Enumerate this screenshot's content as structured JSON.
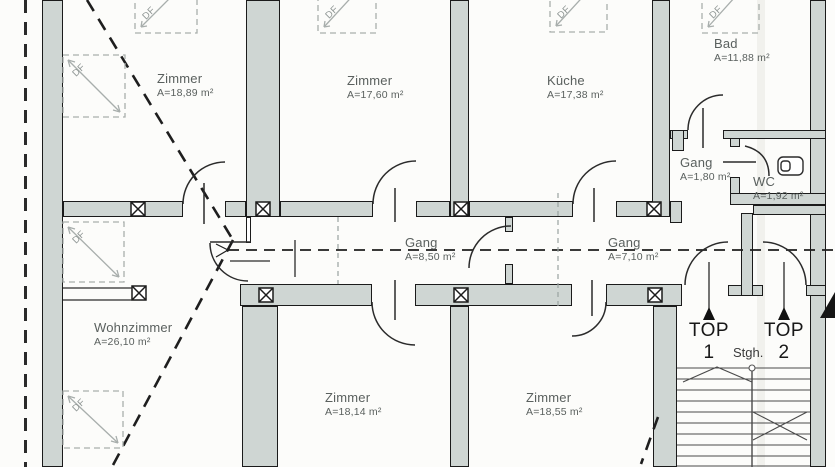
{
  "plan": {
    "rooms": [
      {
        "name": "Zimmer",
        "area": "A=18,89 m²"
      },
      {
        "name": "Zimmer",
        "area": "A=17,60 m²"
      },
      {
        "name": "Küche",
        "area": "A=17,38 m²"
      },
      {
        "name": "Bad",
        "area": "A=11,88 m²"
      },
      {
        "name": "Gang",
        "area": "A=1,80 m²"
      },
      {
        "name": "WC",
        "area": "A=1,92 m²"
      },
      {
        "name": "Gang",
        "area": "A=8,50 m²"
      },
      {
        "name": "Gang",
        "area": "A=7,10 m²"
      },
      {
        "name": "Wohnzimmer",
        "area": "A=26,10 m²"
      },
      {
        "name": "Zimmer",
        "area": "A=18,14 m²"
      },
      {
        "name": "Zimmer",
        "area": "A=18,55 m²"
      }
    ],
    "units": [
      {
        "label": "TOP 1"
      },
      {
        "label": "TOP 2"
      }
    ],
    "stairs_label": "Stgh.",
    "skylight_label": "DF",
    "colors": {
      "wall_fill": "#cfd6d3",
      "wall_edge": "#1b1b1b",
      "label_gray": "#5a605e",
      "line_dark": "#2b2b2b",
      "light_gray": "#a8aeac"
    }
  }
}
